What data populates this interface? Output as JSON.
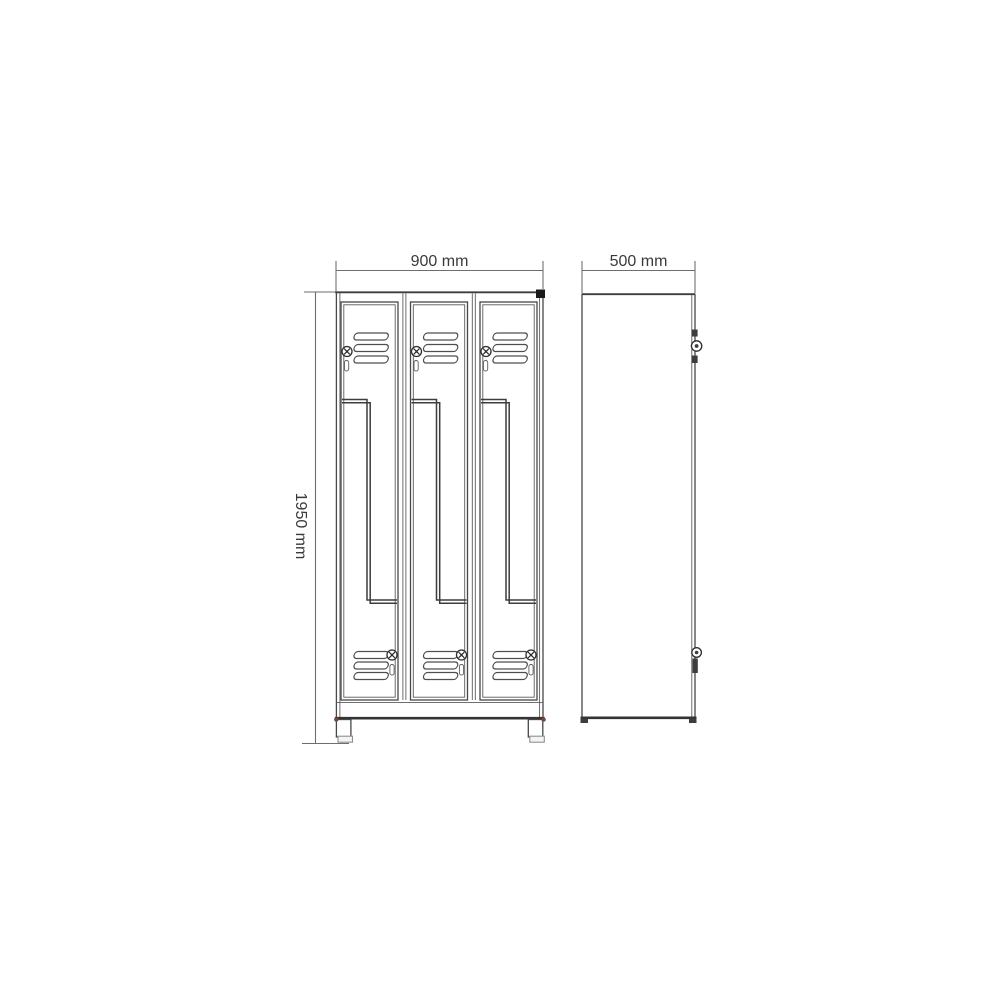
{
  "drawing": {
    "kind": "technical line drawing, locker cabinet with Z-doors, front and side elevation",
    "front_view": {
      "columns": 3,
      "doors_per_column": 2,
      "door_style": "Z",
      "vent_slats_per_door": 3
    },
    "dimensions": {
      "width": {
        "label": "900 mm"
      },
      "depth": {
        "label": "500 mm"
      },
      "height": {
        "label": "1950 mm"
      }
    },
    "colors": {
      "line": "#474747",
      "dimension_line": "#6e6e6e",
      "corner_marker": "#1a1a1a",
      "foot_corner_marker": "#7b4a32"
    }
  }
}
